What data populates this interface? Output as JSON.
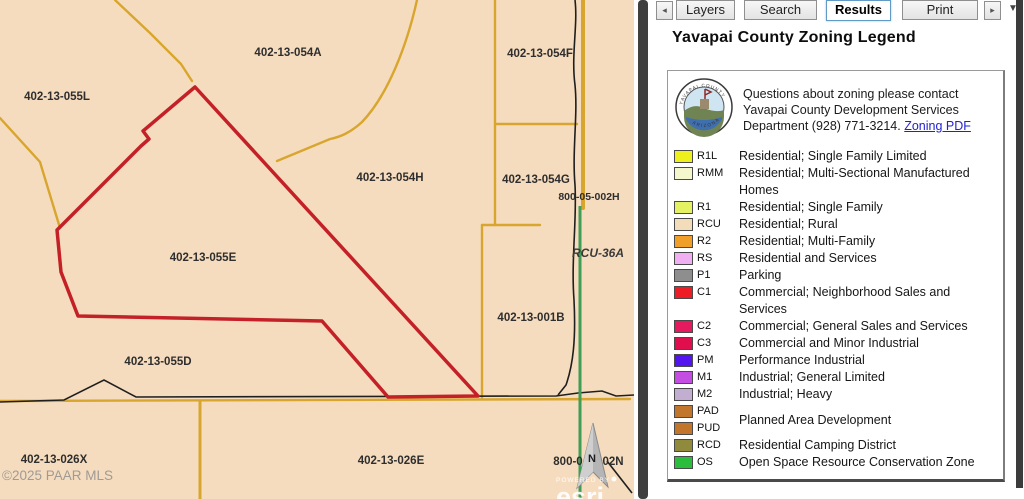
{
  "map": {
    "colors": {
      "bg": "#f6dcbe",
      "parcel_line": "#d8a62e",
      "highlight": "#c32127",
      "road_black": "#1f1f1f",
      "green_line": "#3f9d55",
      "label": "#2e2e2e",
      "watermark": "#8f8f8f"
    },
    "labels": [
      {
        "text": "402-13-054A"
      },
      {
        "text": "402-13-054F"
      },
      {
        "text": "402-13-055L"
      },
      {
        "text": "402-13-054H"
      },
      {
        "text": "402-13-054G"
      },
      {
        "text": "800-05-002H"
      },
      {
        "text": "402-13-055E"
      },
      {
        "text": "402-13-001B"
      },
      {
        "text": "402-13-055D"
      },
      {
        "text": "402-13-026X"
      },
      {
        "text": "402-13-026E"
      }
    ],
    "zone_label": "RCU-36A",
    "label_800_left": "800-0",
    "label_800_right": "02N",
    "north_letter": "N",
    "watermark": "©2025 PAAR MLS",
    "esri": {
      "powered": "POWERED BY",
      "brand": "esri"
    }
  },
  "tabs": {
    "back_glyph": "◂",
    "forward_glyph": "▸",
    "menu_glyph": "▼",
    "items": [
      {
        "label": "Layers"
      },
      {
        "label": "Search"
      },
      {
        "label": "Results"
      },
      {
        "label": "Print"
      }
    ]
  },
  "panel": {
    "title": "Yavapai County Zoning Legend"
  },
  "legend": {
    "seal": {
      "top_text": "YAVAPAI COUNTY",
      "bottom_text": "ARIZONA"
    },
    "contact": {
      "line1": "Questions about zoning please contact",
      "line2": "Yavapai County Development Services",
      "line3": "Department (928) 771-3214.",
      "link": "Zoning PDF"
    },
    "items": [
      {
        "code": "R1L",
        "color": "#eef01e",
        "desc": "Residential; Single Family Limited"
      },
      {
        "code": "RMM",
        "color": "#f4f8cc",
        "desc": "Residential; Multi-Sectional Manufactured Homes"
      },
      {
        "code": "R1",
        "color": "#e4f163",
        "desc": "Residential; Single Family"
      },
      {
        "code": "RCU",
        "color": "#f3dcba",
        "desc": "Residential; Rural"
      },
      {
        "code": "R2",
        "color": "#f0a028",
        "desc": "Residential; Multi-Family"
      },
      {
        "code": "RS",
        "color": "#f0aff0",
        "desc": "Residential and Services"
      },
      {
        "code": "P1",
        "color": "#8e8e8e",
        "desc": "Parking"
      },
      {
        "code": "C1",
        "color": "#ee1c25",
        "desc": "Commercial; Neighborhood Sales and Services"
      },
      {
        "code": "C2",
        "color": "#e61a5e",
        "desc": "Commercial; General Sales and Services"
      },
      {
        "code": "C3",
        "color": "#e00e4d",
        "desc": "Commercial and Minor Industrial"
      },
      {
        "code": "PM",
        "color": "#5414ef",
        "desc": "Performance Industrial"
      },
      {
        "code": "M1",
        "color": "#c44de2",
        "desc": "Industrial; General Limited"
      },
      {
        "code": "M2",
        "color": "#c2aed1",
        "desc": "Industrial; Heavy"
      }
    ],
    "pad_pud": {
      "codes": [
        {
          "code": "PAD",
          "color": "#c1762c"
        },
        {
          "code": "PUD",
          "color": "#c1762c"
        }
      ],
      "desc": "Planned Area Development"
    },
    "tail_items": [
      {
        "code": "RCD",
        "color": "#8f8a3c",
        "desc": "Residential Camping District"
      },
      {
        "code": "OS",
        "color": "#2bbe3c",
        "desc": "Open Space Resource Conservation Zone"
      }
    ]
  }
}
